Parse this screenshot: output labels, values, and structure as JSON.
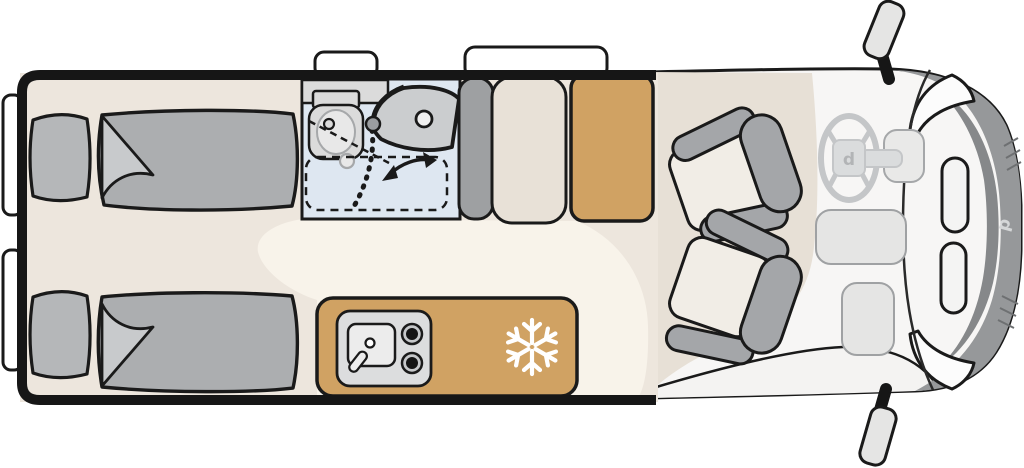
{
  "diagram": {
    "type": "motorhome-floorplan",
    "view": "top-down",
    "front_direction": "right",
    "brand_logo_letter": "d"
  },
  "colors": {
    "outline": "#1a1a1a",
    "wood_tan": "#d0a263",
    "bathroom_blue": "#dee7f1",
    "floor_beige": "#ede6dd",
    "aisle_cream": "#f8f3ea",
    "cab_floor_beige": "#e7e0d6",
    "upholstery_gray": "#acaeb0",
    "pillow_gray": "#b5b7b9",
    "seat_cushion_cream": "#f1ede6",
    "armrest_gray": "#a4a6a9",
    "windshield_gray": "#96989a",
    "appliance_gray": "#dcddde",
    "snowflake_white": "#ffffff"
  },
  "features": {
    "rear_bedroom": {
      "name": "twin-single-beds",
      "bed_count": 2,
      "parts": [
        "pillow",
        "duvet-with-folded-corner"
      ]
    },
    "bathroom": {
      "name": "swivel-bathroom",
      "parts": [
        "toilet",
        "washbasin",
        "shower-tray-dashed",
        "swivel-wall",
        "rotation-arrow"
      ]
    },
    "wardrobe": {
      "name": "wardrobe"
    },
    "kitchen": {
      "name": "kitchen-block",
      "parts": [
        "sink",
        "faucet",
        "two-burner-hob"
      ]
    },
    "refrigerator": {
      "name": "refrigerator",
      "icon": "snowflake-icon"
    },
    "cab": {
      "name": "driver-cab",
      "parts": [
        "swivel-seat-top",
        "swivel-seat-bottom",
        "steering-wheel",
        "dashboard",
        "windshield",
        "side-mirror-top",
        "side-mirror-bottom"
      ]
    },
    "windows": {
      "rear_side_windows": 2,
      "top_side_windows": 2
    }
  }
}
